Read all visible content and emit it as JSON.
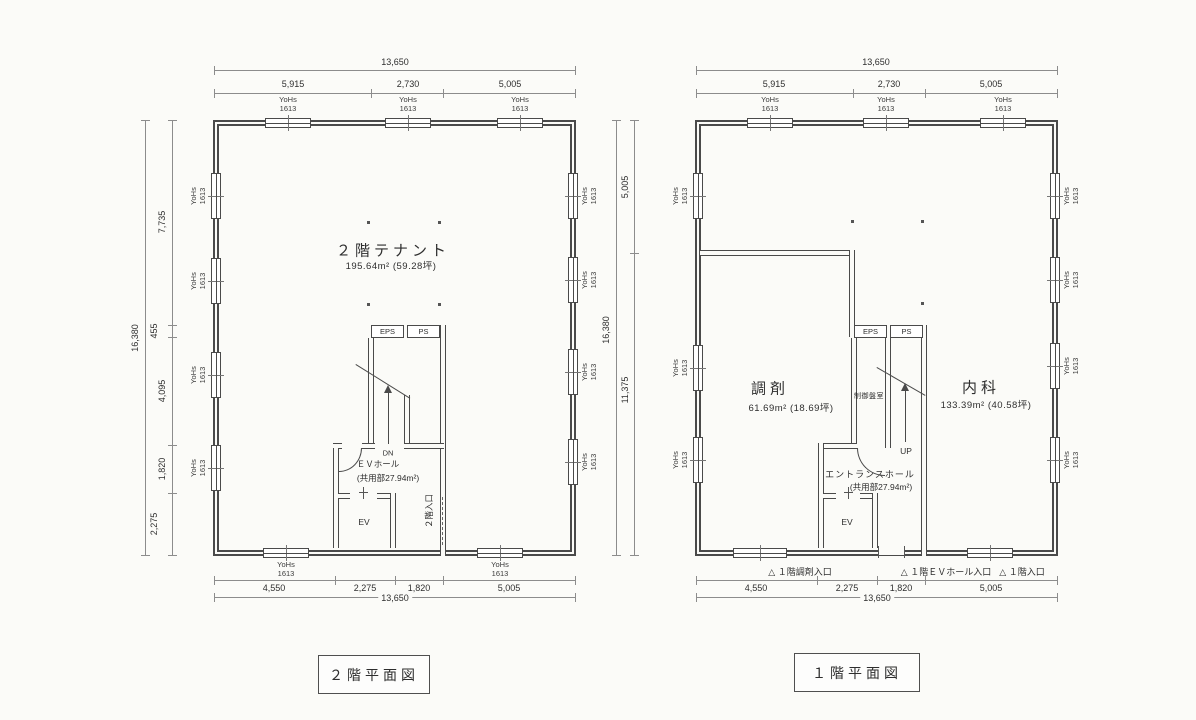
{
  "window_label": {
    "name": "YoHs",
    "size": "1613"
  },
  "plan2f": {
    "caption": "２階平面図",
    "tenant": {
      "name": "２階テナント",
      "area": "195.64m² (59.28坪)"
    },
    "core": {
      "eps": "EPS",
      "ps": "PS",
      "dn": "DN",
      "ev": "EV",
      "ev_hall": "ＥＶホール",
      "ev_hall_area": "(共用部27.94m²)",
      "entrance": "２階入口"
    },
    "dims": {
      "top_total": "13,650",
      "top_segments": [
        "5,915",
        "2,730",
        "5,005"
      ],
      "left_total": "16,380",
      "left_segments": [
        "7,735",
        "455",
        "4,095",
        "1,820",
        "2,275"
      ],
      "bottom_total": "13,650",
      "bottom_segments": [
        "4,550",
        "2,275",
        "1,820",
        "5,005"
      ]
    }
  },
  "plan1f": {
    "caption": "１階平面図",
    "rooms": {
      "pharmacy": {
        "name": "調剤",
        "area": "61.69m² (18.69坪)"
      },
      "internal_medicine": {
        "name": "内科",
        "area": "133.39m² (40.58坪)"
      },
      "control_room": "制御盤室"
    },
    "core": {
      "eps": "EPS",
      "ps": "PS",
      "up": "UP",
      "ev": "EV",
      "hall": "エントランスホール",
      "hall_area": "(共用部27.94m²)"
    },
    "entrances": [
      "△ １階調剤入口",
      "△ １階ＥＶホール入口",
      "△ １階入口"
    ],
    "dims": {
      "top_total": "13,650",
      "top_segments": [
        "5,915",
        "2,730",
        "5,005"
      ],
      "left_total": "16,380",
      "left_segments": [
        "5,005",
        "11,375"
      ],
      "bottom_total": "13,650",
      "bottom_segments": [
        "4,550",
        "2,275",
        "1,820",
        "5,005"
      ]
    }
  }
}
